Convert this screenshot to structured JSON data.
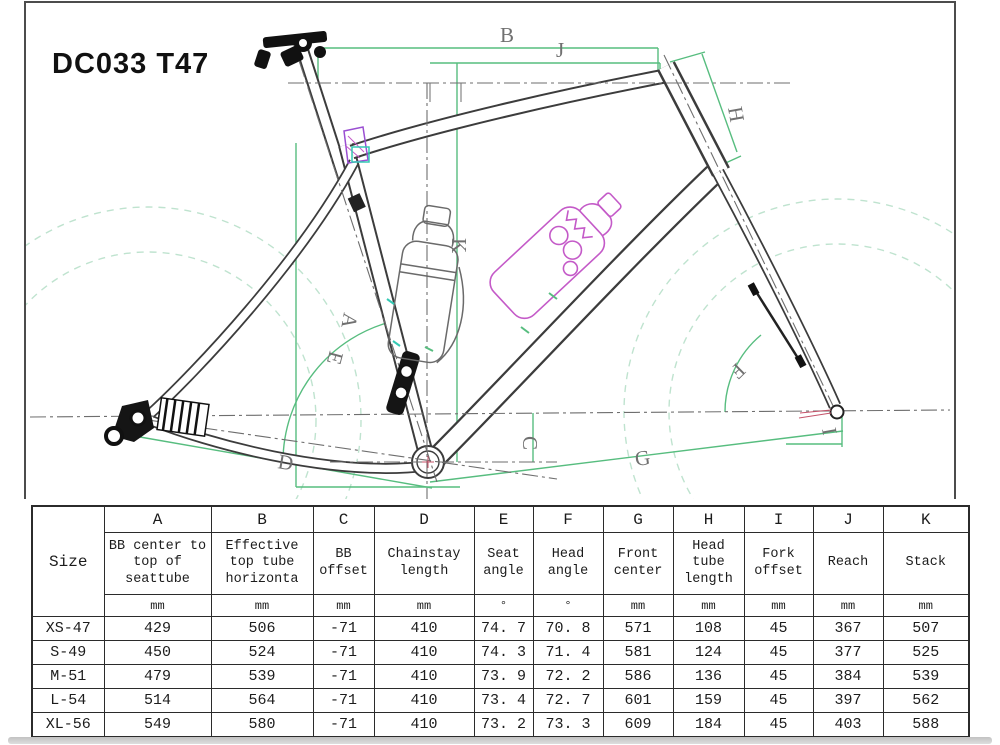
{
  "title": "DC033 T47",
  "diagram": {
    "labels": {
      "a": "A",
      "b": "B",
      "c": "C",
      "d": "D",
      "e": "E",
      "f": "F",
      "g": "G",
      "h": "H",
      "i": "I",
      "j": "J",
      "k": "K"
    },
    "colors": {
      "dimension_green": "#57bd7f",
      "wheel_dashed": "#bfe3cf",
      "centerline_gray": "#6e6e6e",
      "frame_line": "#3c3c3c",
      "accent_magenta": "#c45ac8",
      "accent_cyan": "#35c9b4",
      "accent_red": "#c5536a"
    }
  },
  "table": {
    "size_header": "Size",
    "columns": [
      {
        "letter": "A",
        "desc": "BB center to top of seattube",
        "unit": "mm"
      },
      {
        "letter": "B",
        "desc": "Effective top tube horizonta",
        "unit": "mm"
      },
      {
        "letter": "C",
        "desc": "BB offset",
        "unit": "mm"
      },
      {
        "letter": "D",
        "desc": "Chainstay length",
        "unit": "mm"
      },
      {
        "letter": "E",
        "desc": "Seat angle",
        "unit": "°"
      },
      {
        "letter": "F",
        "desc": "Head angle",
        "unit": "°"
      },
      {
        "letter": "G",
        "desc": "Front center",
        "unit": "mm"
      },
      {
        "letter": "H",
        "desc": "Head tube length",
        "unit": "mm"
      },
      {
        "letter": "I",
        "desc": "Fork offset",
        "unit": "mm"
      },
      {
        "letter": "J",
        "desc": "Reach",
        "unit": "mm"
      },
      {
        "letter": "K",
        "desc": "Stack",
        "unit": "mm"
      }
    ],
    "rows": [
      {
        "size": "XS-47",
        "values": [
          "429",
          "506",
          "-71",
          "410",
          "74. 7",
          "70. 8",
          "571",
          "108",
          "45",
          "367",
          "507"
        ]
      },
      {
        "size": "S-49",
        "values": [
          "450",
          "524",
          "-71",
          "410",
          "74. 3",
          "71. 4",
          "581",
          "124",
          "45",
          "377",
          "525"
        ]
      },
      {
        "size": "M-51",
        "values": [
          "479",
          "539",
          "-71",
          "410",
          "73. 9",
          "72. 2",
          "586",
          "136",
          "45",
          "384",
          "539"
        ]
      },
      {
        "size": "L-54",
        "values": [
          "514",
          "564",
          "-71",
          "410",
          "73. 4",
          "72. 7",
          "601",
          "159",
          "45",
          "397",
          "562"
        ]
      },
      {
        "size": "XL-56",
        "values": [
          "549",
          "580",
          "-71",
          "410",
          "73. 2",
          "73. 3",
          "609",
          "184",
          "45",
          "403",
          "588"
        ]
      }
    ]
  }
}
